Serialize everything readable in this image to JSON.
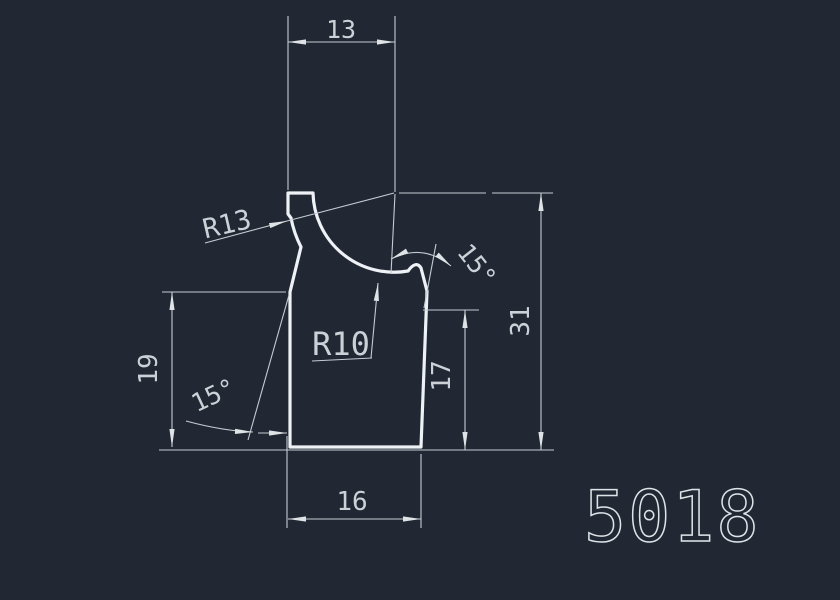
{
  "drawing": {
    "part_number": "5018",
    "colors": {
      "background": "#212833",
      "outline": "#eef1f5",
      "dimension_lines": "#c6ccd4",
      "text": "#ccd1d8"
    },
    "dimensions": {
      "top_width": "13",
      "overall_height": "31",
      "bottom_width": "16",
      "left_height": "19",
      "right_height": "17",
      "radius_left_edge": "R13",
      "radius_top_cove": "R10",
      "angle_top_right": "15°",
      "angle_bottom_left": "15°"
    }
  }
}
